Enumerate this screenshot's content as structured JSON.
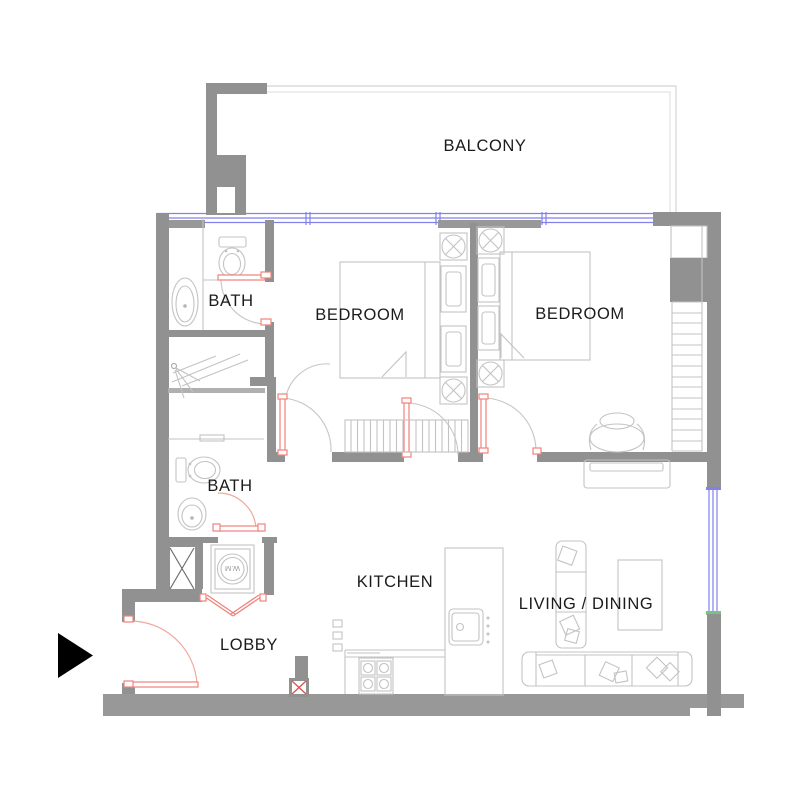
{
  "title": "Apartment floor plan",
  "labels": {
    "balcony": "BALCONY",
    "bedroom_left": "BEDROOM",
    "bedroom_right": "BEDROOM",
    "bath_upper": "BATH",
    "bath_lower": "BATH",
    "kitchen": "KITCHEN",
    "living_dining": "LIVING / DINING",
    "lobby": "LOBBY",
    "washing_machine": "W.M"
  },
  "icons": {
    "entry_arrow": "entry-arrow-right-triangle",
    "shaft_cross": "service-shaft-x",
    "ceiling_light": "circle-x-light-symbol"
  },
  "colors": {
    "wall": "#919191",
    "window": "#8181ee",
    "door": "#ef837b",
    "furniture_line": "#c3c3c3",
    "text": "#1b1b1b",
    "window_end_green": "#7cc47c",
    "entry_arrow": "#000000",
    "background": "#ffffff"
  }
}
